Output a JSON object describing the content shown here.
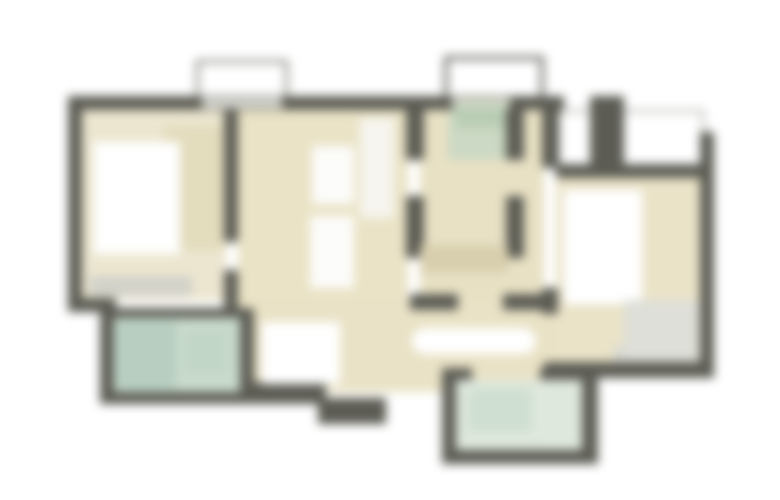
{
  "page": {
    "background": "#ffffff",
    "description": "blurred-floor-plan"
  },
  "floorplan": {
    "canvas": {
      "width": 780,
      "height": 500,
      "blur_px": 5,
      "background": "#ffffff"
    },
    "palette": {
      "wall": "#5c5c54",
      "floor_beige": "#eae3c6",
      "tile_green": "#ccd9c4",
      "tile_mint": "#c9dbcd",
      "tile_light": "#dfe8dd",
      "furniture_white": "#ffffff",
      "window_gray": "#d6d6d0",
      "outline_gray": "#8a8a82",
      "rug_tan": "#d8cfae"
    },
    "layers": [
      {
        "name": "balcony-top-left-outline",
        "type": "outline",
        "x": 196,
        "y": 60,
        "w": 92,
        "h": 44,
        "border": 3,
        "color": "#787870"
      },
      {
        "name": "balcony-top-center-outline",
        "type": "outline",
        "x": 444,
        "y": 56,
        "w": 100,
        "h": 44,
        "border": 4,
        "color": "#62625a"
      },
      {
        "name": "balcony-right-outline",
        "type": "outline",
        "x": 558,
        "y": 110,
        "w": 146,
        "h": 56,
        "border": 2,
        "color": "#9a9a92"
      },
      {
        "name": "bedroom-left-floor",
        "type": "floor",
        "x": 82,
        "y": 108,
        "w": 144,
        "h": 192,
        "color": "#ece6d0"
      },
      {
        "name": "wardrobe-left-wedge",
        "type": "floor",
        "x": 164,
        "y": 126,
        "w": 62,
        "h": 124,
        "color": "#e3dcbd"
      },
      {
        "name": "living-room-floor",
        "type": "floor",
        "x": 238,
        "y": 108,
        "w": 170,
        "h": 284,
        "color": "#eae3c6"
      },
      {
        "name": "corridor-floor",
        "type": "floor",
        "x": 420,
        "y": 108,
        "w": 124,
        "h": 284,
        "color": "#e8e1c4"
      },
      {
        "name": "hallway-floor",
        "type": "floor",
        "x": 252,
        "y": 300,
        "w": 306,
        "h": 92,
        "color": "#e9e2c6"
      },
      {
        "name": "bedroom-right-floor",
        "type": "floor",
        "x": 556,
        "y": 176,
        "w": 146,
        "h": 188,
        "color": "#eae3c8"
      },
      {
        "name": "wc-floor",
        "type": "floor",
        "x": 448,
        "y": 102,
        "w": 66,
        "h": 58,
        "color": "#ccd9c4"
      },
      {
        "name": "bath-left-floor",
        "type": "floor",
        "x": 114,
        "y": 318,
        "w": 126,
        "h": 76,
        "color": "#c9dbcd"
      },
      {
        "name": "bath-bottom-floor",
        "type": "floor",
        "x": 456,
        "y": 380,
        "w": 126,
        "h": 72,
        "color": "#dfe8dd"
      },
      {
        "name": "top-wall",
        "type": "wall",
        "x": 68,
        "y": 96,
        "w": 496,
        "h": 14
      },
      {
        "name": "top-wall-right-pillar",
        "type": "wall",
        "x": 590,
        "y": 96,
        "w": 34,
        "h": 74
      },
      {
        "name": "left-wall",
        "type": "wall",
        "x": 68,
        "y": 96,
        "w": 14,
        "h": 216
      },
      {
        "name": "left-corner-wall",
        "type": "wall",
        "x": 68,
        "y": 298,
        "w": 48,
        "h": 14
      },
      {
        "name": "bath-left-top-wall",
        "type": "wall",
        "x": 100,
        "y": 308,
        "w": 152,
        "h": 10
      },
      {
        "name": "bath-left-left-wall",
        "type": "wall",
        "x": 100,
        "y": 310,
        "w": 14,
        "h": 94
      },
      {
        "name": "bath-left-bottom-wall",
        "type": "wall",
        "x": 100,
        "y": 392,
        "w": 222,
        "h": 12
      },
      {
        "name": "bath-left-right-wall",
        "type": "wall",
        "x": 240,
        "y": 308,
        "w": 14,
        "h": 96
      },
      {
        "name": "bedroom-divider-wall-upper",
        "type": "wall",
        "x": 224,
        "y": 108,
        "w": 14,
        "h": 134
      },
      {
        "name": "bedroom-divider-wall-lower",
        "type": "wall",
        "x": 224,
        "y": 270,
        "w": 14,
        "h": 42
      },
      {
        "name": "living-right-wall-upper",
        "type": "wall",
        "x": 406,
        "y": 108,
        "w": 18,
        "h": 52
      },
      {
        "name": "living-right-wall-mid",
        "type": "wall",
        "x": 406,
        "y": 196,
        "w": 18,
        "h": 62
      },
      {
        "name": "living-right-wall-stub",
        "type": "wall",
        "x": 410,
        "y": 294,
        "w": 48,
        "h": 16
      },
      {
        "name": "wc-right-wall-upper",
        "type": "wall",
        "x": 506,
        "y": 96,
        "w": 18,
        "h": 64
      },
      {
        "name": "wc-right-wall-mid",
        "type": "wall",
        "x": 506,
        "y": 196,
        "w": 18,
        "h": 62
      },
      {
        "name": "wc-right-wall-stub",
        "type": "wall",
        "x": 503,
        "y": 294,
        "w": 46,
        "h": 16
      },
      {
        "name": "corridor-right-pillar",
        "type": "wall",
        "x": 542,
        "y": 96,
        "w": 16,
        "h": 72
      },
      {
        "name": "corridor-right-low",
        "type": "wall",
        "x": 542,
        "y": 288,
        "w": 16,
        "h": 26
      },
      {
        "name": "bedroom-right-top-wall",
        "type": "wall",
        "x": 556,
        "y": 164,
        "w": 158,
        "h": 14
      },
      {
        "name": "right-wall",
        "type": "wall",
        "x": 700,
        "y": 132,
        "w": 14,
        "h": 246
      },
      {
        "name": "bedroom-right-bottom-wall",
        "type": "wall",
        "x": 544,
        "y": 362,
        "w": 170,
        "h": 16
      },
      {
        "name": "hall-bottom-wall",
        "type": "wall",
        "x": 240,
        "y": 382,
        "w": 86,
        "h": 18
      },
      {
        "name": "entry-step-wall",
        "type": "wall",
        "x": 318,
        "y": 398,
        "w": 68,
        "h": 26
      },
      {
        "name": "bath-bottom-left-wall",
        "type": "wall",
        "x": 442,
        "y": 368,
        "w": 14,
        "h": 96
      },
      {
        "name": "bath-bottom-right-wall",
        "type": "wall",
        "x": 582,
        "y": 368,
        "w": 16,
        "h": 96
      },
      {
        "name": "bath-bottom-bottom-wall",
        "type": "wall",
        "x": 442,
        "y": 450,
        "w": 156,
        "h": 14
      },
      {
        "name": "bath-bottom-top-wall",
        "type": "wall",
        "x": 540,
        "y": 368,
        "w": 58,
        "h": 12
      },
      {
        "name": "bath-bottom-top-stub",
        "type": "wall",
        "x": 442,
        "y": 368,
        "w": 30,
        "h": 12
      },
      {
        "name": "window-top-left",
        "type": "window",
        "x": 202,
        "y": 98,
        "w": 80,
        "h": 10,
        "color": "#dcdcd6"
      },
      {
        "name": "window-top-center",
        "type": "window",
        "x": 452,
        "y": 98,
        "w": 58,
        "h": 10,
        "color": "#d8ddcc"
      },
      {
        "name": "window-bedroom-right",
        "type": "window",
        "x": 614,
        "y": 346,
        "w": 84,
        "h": 16,
        "color": "#d8d8d2"
      },
      {
        "name": "dresser-left-bedroom",
        "type": "window",
        "x": 90,
        "y": 276,
        "w": 102,
        "h": 20,
        "color": "#d2d2ca"
      },
      {
        "name": "bed-left",
        "type": "furniture",
        "x": 94,
        "y": 142,
        "w": 86,
        "h": 112,
        "color": "#ffffff"
      },
      {
        "name": "shelf-living-upper",
        "type": "furniture",
        "x": 312,
        "y": 146,
        "w": 42,
        "h": 58,
        "color": "#fcfcfa"
      },
      {
        "name": "shelf-living-lower",
        "type": "furniture",
        "x": 310,
        "y": 216,
        "w": 44,
        "h": 72,
        "color": "#fcfcfa"
      },
      {
        "name": "cabinet-top-living",
        "type": "furniture",
        "x": 360,
        "y": 118,
        "w": 34,
        "h": 100,
        "color": "#f6f5ef"
      },
      {
        "name": "kitchen-block",
        "type": "furniture",
        "x": 262,
        "y": 322,
        "w": 78,
        "h": 62,
        "color": "#ffffff"
      },
      {
        "name": "hall-table",
        "type": "furniture",
        "x": 412,
        "y": 328,
        "w": 124,
        "h": 26,
        "color": "#ffffff",
        "radius": 13
      },
      {
        "name": "corridor-rug",
        "type": "furniture",
        "x": 420,
        "y": 245,
        "w": 88,
        "h": 28,
        "color": "#d8cfae"
      },
      {
        "name": "bed-right",
        "type": "furniture",
        "x": 564,
        "y": 190,
        "w": 78,
        "h": 114,
        "color": "#ffffff"
      },
      {
        "name": "rug-bedroom-right",
        "type": "furniture",
        "x": 624,
        "y": 300,
        "w": 76,
        "h": 58,
        "color": "#dedfd8"
      },
      {
        "name": "wc-fixture",
        "type": "furniture",
        "x": 456,
        "y": 106,
        "w": 50,
        "h": 22,
        "color": "#b9cdb4"
      },
      {
        "name": "tub-bath-left",
        "type": "furniture",
        "x": 118,
        "y": 322,
        "w": 58,
        "h": 68,
        "color": "#b7cec0"
      },
      {
        "name": "sink-bath-left",
        "type": "furniture",
        "x": 184,
        "y": 330,
        "w": 44,
        "h": 44,
        "color": "#c2d6c8"
      },
      {
        "name": "fixture-bath-bottom",
        "type": "furniture",
        "x": 468,
        "y": 388,
        "w": 64,
        "h": 44,
        "color": "#cfdfd2"
      }
    ]
  }
}
